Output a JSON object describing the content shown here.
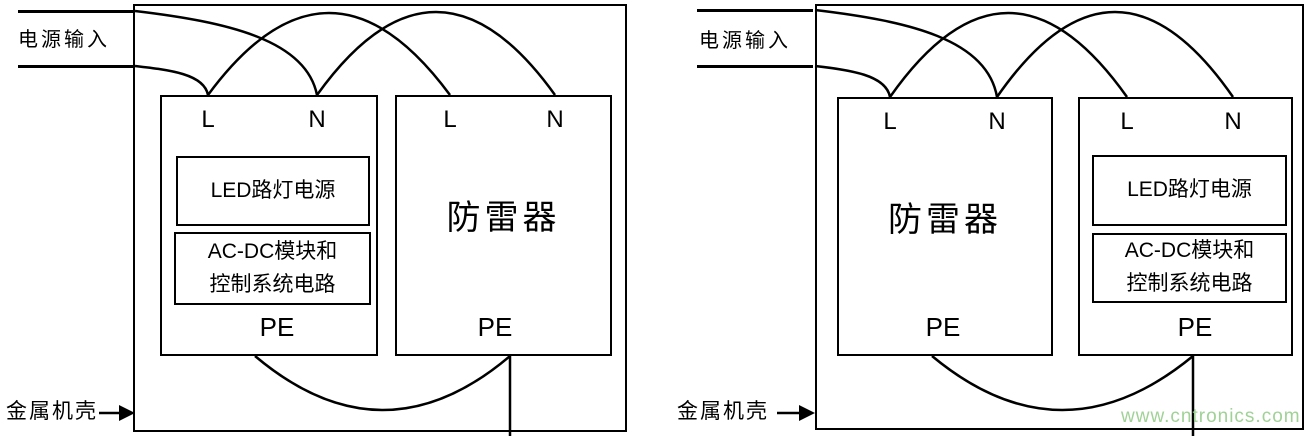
{
  "figure": {
    "panels": [
      {
        "id": "left-panel",
        "power_input": "电源输入",
        "chassis": "金属机壳",
        "units": [
          {
            "kind": "led-power-unit",
            "terminal_l": "L",
            "terminal_n": "N",
            "pe": "PE",
            "modules": {
              "led": "LED路灯电源",
              "acdc_line1": "AC-DC模块和",
              "acdc_line2": "控制系统电路"
            }
          },
          {
            "kind": "surge-arrester",
            "label": "防雷器",
            "terminal_l": "L",
            "terminal_n": "N",
            "pe": "PE"
          }
        ]
      },
      {
        "id": "right-panel",
        "power_input": "电源输入",
        "chassis": "金属机壳",
        "units": [
          {
            "kind": "surge-arrester",
            "label": "防雷器",
            "terminal_l": "L",
            "terminal_n": "N",
            "pe": "PE"
          },
          {
            "kind": "led-power-unit",
            "terminal_l": "L",
            "terminal_n": "N",
            "pe": "PE",
            "modules": {
              "led": "LED路灯电源",
              "acdc_line1": "AC-DC模块和",
              "acdc_line2": "控制系统电路"
            }
          }
        ]
      }
    ],
    "watermark": {
      "text": "www.cntronics.com",
      "color": "#a0d296"
    },
    "colors": {
      "line": "#000000",
      "background": "#ffffff"
    }
  }
}
